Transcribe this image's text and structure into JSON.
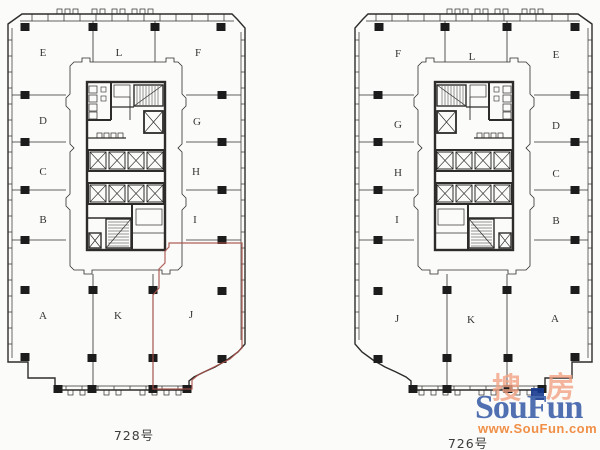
{
  "canvas": {
    "background": "#fbfbf9",
    "line_color": "#2e2c2a",
    "column_color": "#1c1c1c",
    "highlight_color": "#a85048"
  },
  "plans": [
    {
      "id": "plan-728",
      "caption": "728号",
      "caption_x": 134,
      "caption_y": 440,
      "mirrored": false,
      "highlight_unit": "J",
      "rooms": [
        {
          "label": "E",
          "x": 43,
          "y": 56
        },
        {
          "label": "L",
          "x": 119,
          "y": 56
        },
        {
          "label": "F",
          "x": 198,
          "y": 56
        },
        {
          "label": "D",
          "x": 43,
          "y": 124
        },
        {
          "label": "G",
          "x": 197,
          "y": 125
        },
        {
          "label": "C",
          "x": 43,
          "y": 175
        },
        {
          "label": "H",
          "x": 196,
          "y": 175
        },
        {
          "label": "B",
          "x": 43,
          "y": 223
        },
        {
          "label": "I",
          "x": 195,
          "y": 223
        },
        {
          "label": "A",
          "x": 43,
          "y": 319
        },
        {
          "label": "K",
          "x": 118,
          "y": 319
        },
        {
          "label": "J",
          "x": 191,
          "y": 318
        }
      ]
    },
    {
      "id": "plan-726",
      "caption": "726号",
      "caption_x": 468,
      "caption_y": 448,
      "mirrored": true,
      "highlight_unit": null,
      "rooms": [
        {
          "label": "F",
          "x": 398,
          "y": 57
        },
        {
          "label": "L",
          "x": 472,
          "y": 60
        },
        {
          "label": "E",
          "x": 556,
          "y": 58
        },
        {
          "label": "G",
          "x": 398,
          "y": 128
        },
        {
          "label": "D",
          "x": 556,
          "y": 129
        },
        {
          "label": "H",
          "x": 398,
          "y": 176
        },
        {
          "label": "C",
          "x": 556,
          "y": 177
        },
        {
          "label": "I",
          "x": 397,
          "y": 223
        },
        {
          "label": "B",
          "x": 556,
          "y": 224
        },
        {
          "label": "J",
          "x": 397,
          "y": 322
        },
        {
          "label": "K",
          "x": 471,
          "y": 323
        },
        {
          "label": "A",
          "x": 555,
          "y": 322
        }
      ]
    }
  ],
  "watermark": {
    "cn_first": "搜",
    "cn_second": "房",
    "brand": "SouFun",
    "url": "www.SouFun.com",
    "brand_color": "#4769ae",
    "url_color": "#f08a3e",
    "cn_color": "#f2a384",
    "flag_color": "#16388e"
  }
}
